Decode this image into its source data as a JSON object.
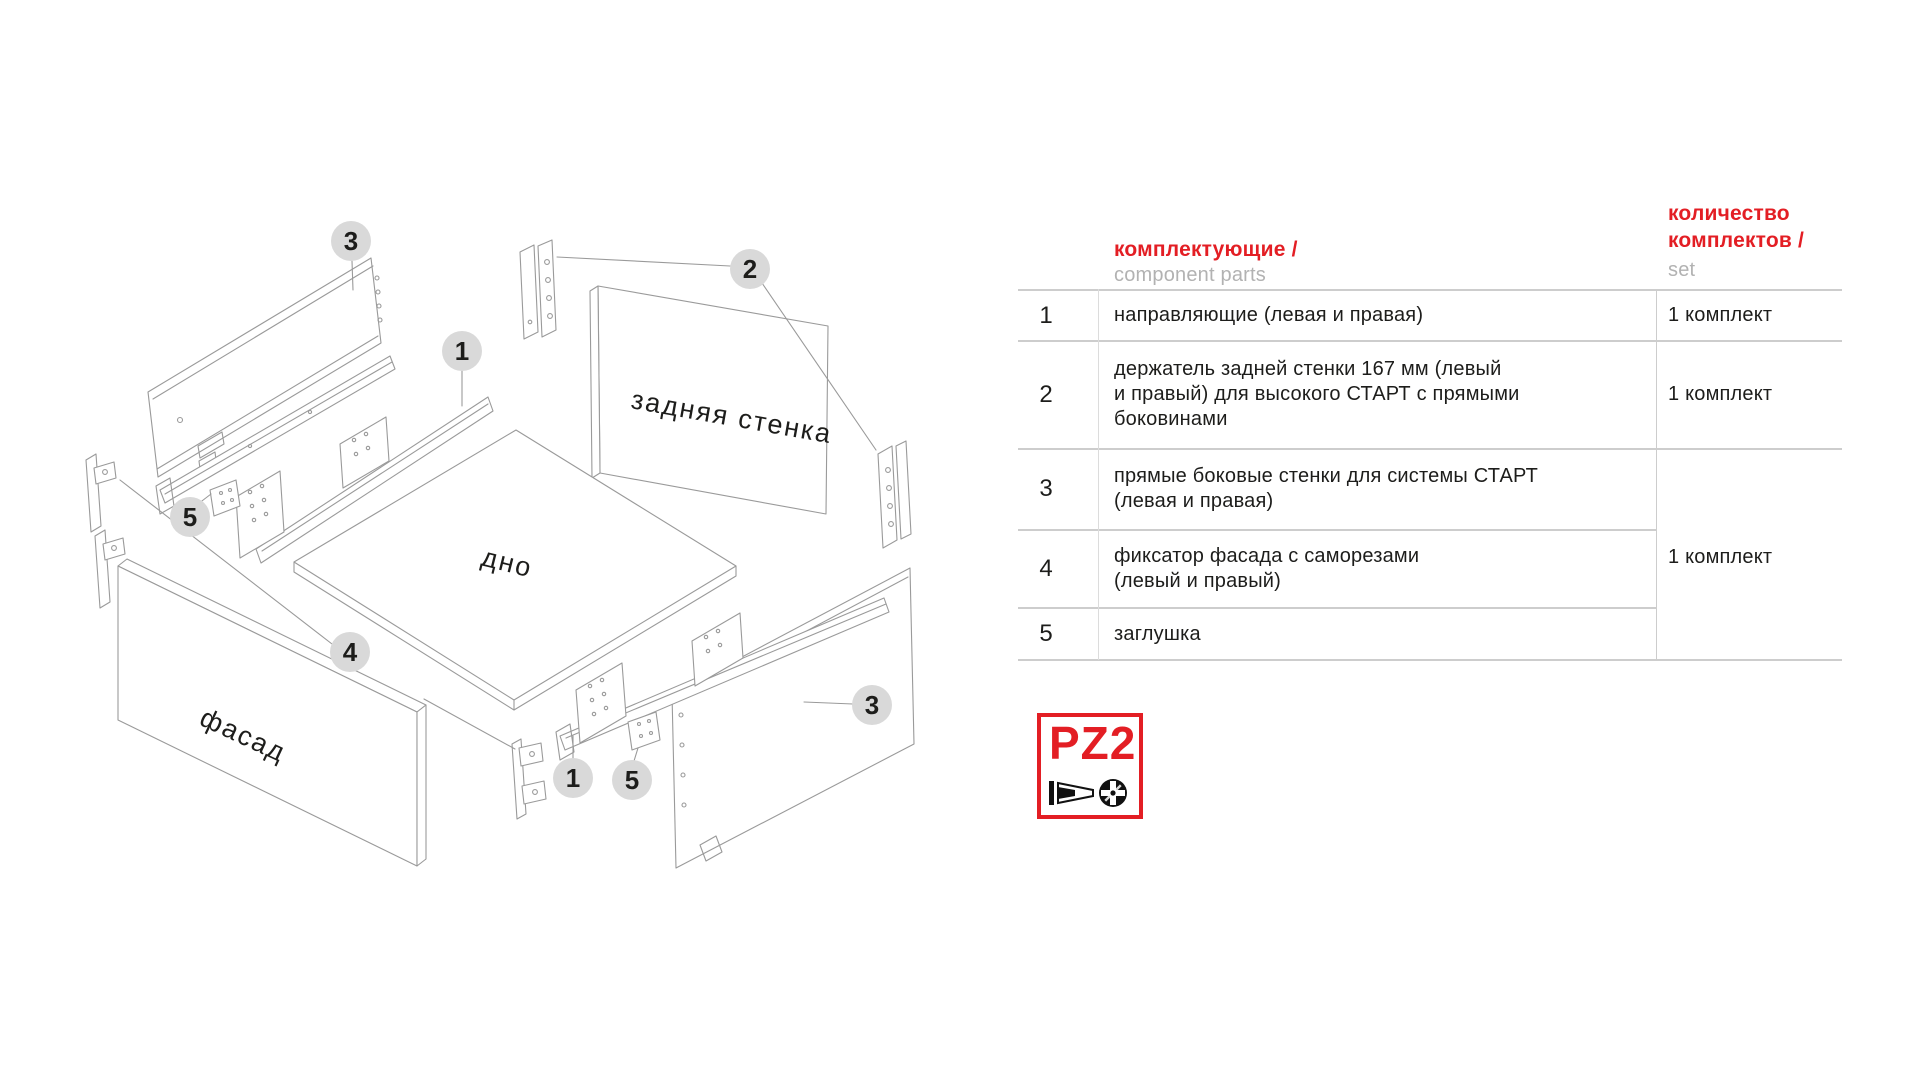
{
  "diagram": {
    "part_labels": {
      "back_wall": "задняя стенка",
      "bottom": "дно",
      "front": "фасад"
    },
    "callouts": [
      "3",
      "2",
      "1",
      "5",
      "4",
      "3",
      "1",
      "5"
    ]
  },
  "table": {
    "header": {
      "col_parts_ru": "комплектующие /",
      "col_parts_en": "component parts",
      "col_qty_ru_1": "количество",
      "col_qty_ru_2": "комплектов /",
      "col_qty_en": "set"
    },
    "rows": [
      {
        "num": "1",
        "desc": [
          "направляющие (левая и правая)"
        ],
        "qty": "1 комплект"
      },
      {
        "num": "2",
        "desc": [
          "держатель задней стенки 167 мм (левый",
          "и правый) для высокого СТАРТ с прямыми",
          "боковинами"
        ],
        "qty": "1 комплект"
      },
      {
        "num": "3",
        "desc": [
          "прямые боковые стенки для системы СТАРТ",
          "(левая и правая)"
        ],
        "qty": ""
      },
      {
        "num": "4",
        "desc": [
          "фиксатор фасада с саморезами",
          "(левый и правый)"
        ],
        "qty": ""
      },
      {
        "num": "5",
        "desc": [
          "заглушка"
        ],
        "qty": ""
      }
    ],
    "qty_merged_rows_3_5": "1 комплект"
  },
  "logo": {
    "text": "PZ2"
  },
  "colors": {
    "accent_red": "#e31e24",
    "muted_gray": "#b2b2b2",
    "table_line_gray": "#cdcdcd",
    "drawing_line_gray": "#9a9a9a",
    "callout_fill": "#d9d9d9",
    "text_black": "#1d1d1b"
  }
}
